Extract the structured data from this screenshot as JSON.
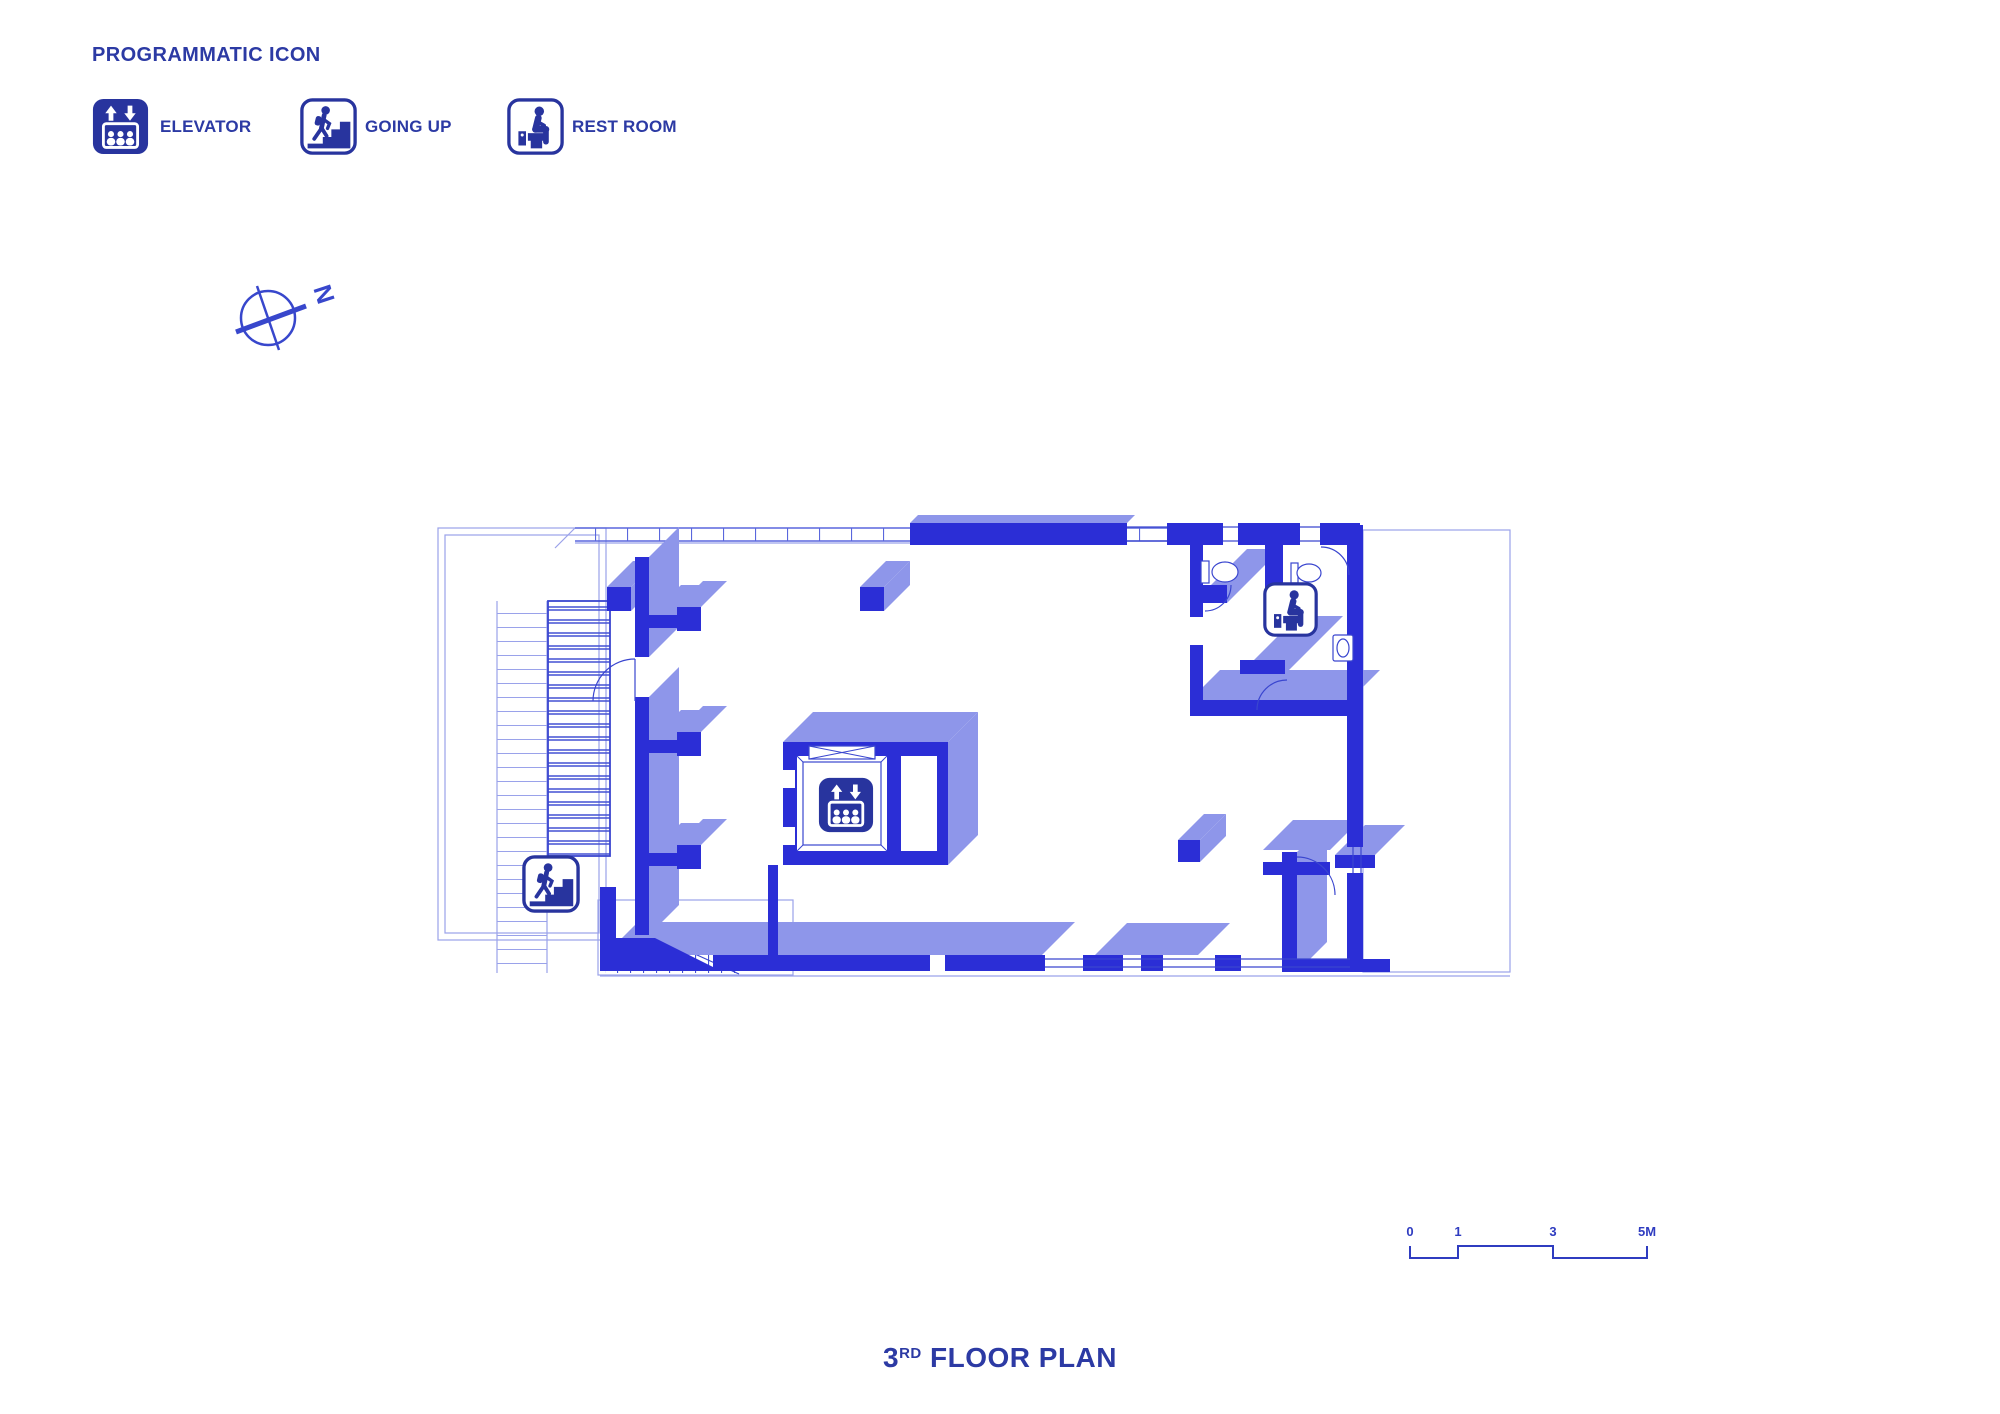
{
  "drawing": {
    "kind": "architectural floor plan",
    "background": "#ffffff"
  },
  "palette": {
    "wall_dark": "#2b2ed6",
    "wall_light": "#8e96ea",
    "detail_line": "#3a46cf",
    "outline_thin": "#9aa2ea",
    "icon_navy": "#28349e",
    "text_blue": "#2c3aa4"
  },
  "legend": {
    "title": "PROGRAMMATIC ICON",
    "items": [
      {
        "icon": "elevator-icon",
        "label": "ELEVATOR"
      },
      {
        "icon": "stairs-up-icon",
        "label": "GOING UP"
      },
      {
        "icon": "restroom-icon",
        "label": "REST ROOM"
      }
    ]
  },
  "compass": {
    "label": "N"
  },
  "scale_bar": {
    "labels": [
      "0",
      "1",
      "3",
      "5M"
    ]
  },
  "plan_title": {
    "number": "3",
    "ordinal": "RD",
    "rest": " FLOOR PLAN"
  },
  "plan": {
    "placed_icons": [
      "stairs-up-icon",
      "elevator-icon",
      "restroom-icon"
    ]
  }
}
